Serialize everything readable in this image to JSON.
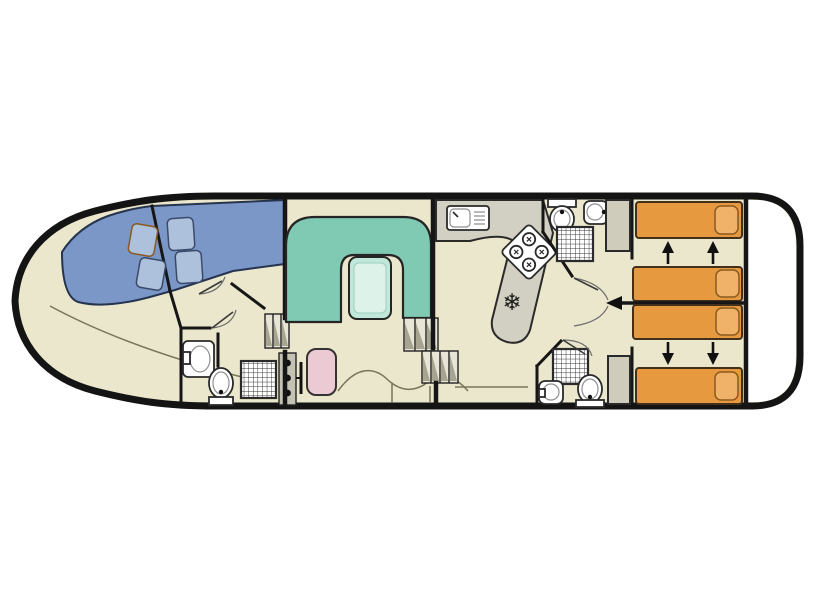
{
  "meta": {
    "title": "Houseboat deck plan",
    "type": "floor-plan",
    "orientation": "bow-left-stern-right"
  },
  "colors": {
    "background": "#ffffff",
    "floor": "#ebe7cc",
    "hull_outline": "#141414",
    "wall": "#161616",
    "stern_deck": "#ffffff",
    "bow_bed": "#7b97c7",
    "bow_pillow": "#adc1dd",
    "sofa": "#80c9b2",
    "table": "#c0e7d9",
    "table_inner": "#ddf3ea",
    "bed": "#e6993f",
    "bed_pillow": "#f0b269",
    "counter": "#d2d0c2",
    "cabinet": "#cfccbc",
    "steps": "#e8e5d6",
    "console": "#c4c2b2",
    "seat": "#ebcad3",
    "fixture": "#ffffff"
  },
  "icons": {
    "fridge": "❄"
  },
  "rooms": [
    {
      "id": "bow-cabin",
      "name": "Bow cabin",
      "furniture": [
        "angled double berth",
        "4 pillows",
        "curved settee"
      ]
    },
    {
      "id": "bow-bathroom",
      "name": "Bow bathroom",
      "furniture": [
        "washbasin",
        "toilet",
        "shower"
      ]
    },
    {
      "id": "helm",
      "name": "Helm station",
      "furniture": [
        "side-deck steps",
        "instrument console",
        "steering wheel",
        "helm seat"
      ]
    },
    {
      "id": "saloon",
      "name": "Saloon",
      "furniture": [
        "U-shaped sofa",
        "table",
        "two step flights"
      ]
    },
    {
      "id": "galley",
      "name": "Galley",
      "furniture": [
        "sink with drainer",
        "4-burner hob",
        "refrigerator"
      ]
    },
    {
      "id": "bathroom-top",
      "name": "Aft bathroom port",
      "furniture": [
        "toilet",
        "washbasin",
        "shower",
        "wardrobe"
      ]
    },
    {
      "id": "bathroom-bottom",
      "name": "Aft bathroom starboard",
      "furniture": [
        "shower",
        "washbasin",
        "toilet",
        "wardrobe"
      ]
    },
    {
      "id": "cabin-top",
      "name": "Aft cabin port",
      "furniture": [
        "single bed",
        "sliding single bed"
      ]
    },
    {
      "id": "cabin-bottom",
      "name": "Aft cabin starboard",
      "furniture": [
        "sliding single bed",
        "single bed"
      ]
    },
    {
      "id": "stern-deck",
      "name": "Stern deck",
      "furniture": []
    }
  ]
}
